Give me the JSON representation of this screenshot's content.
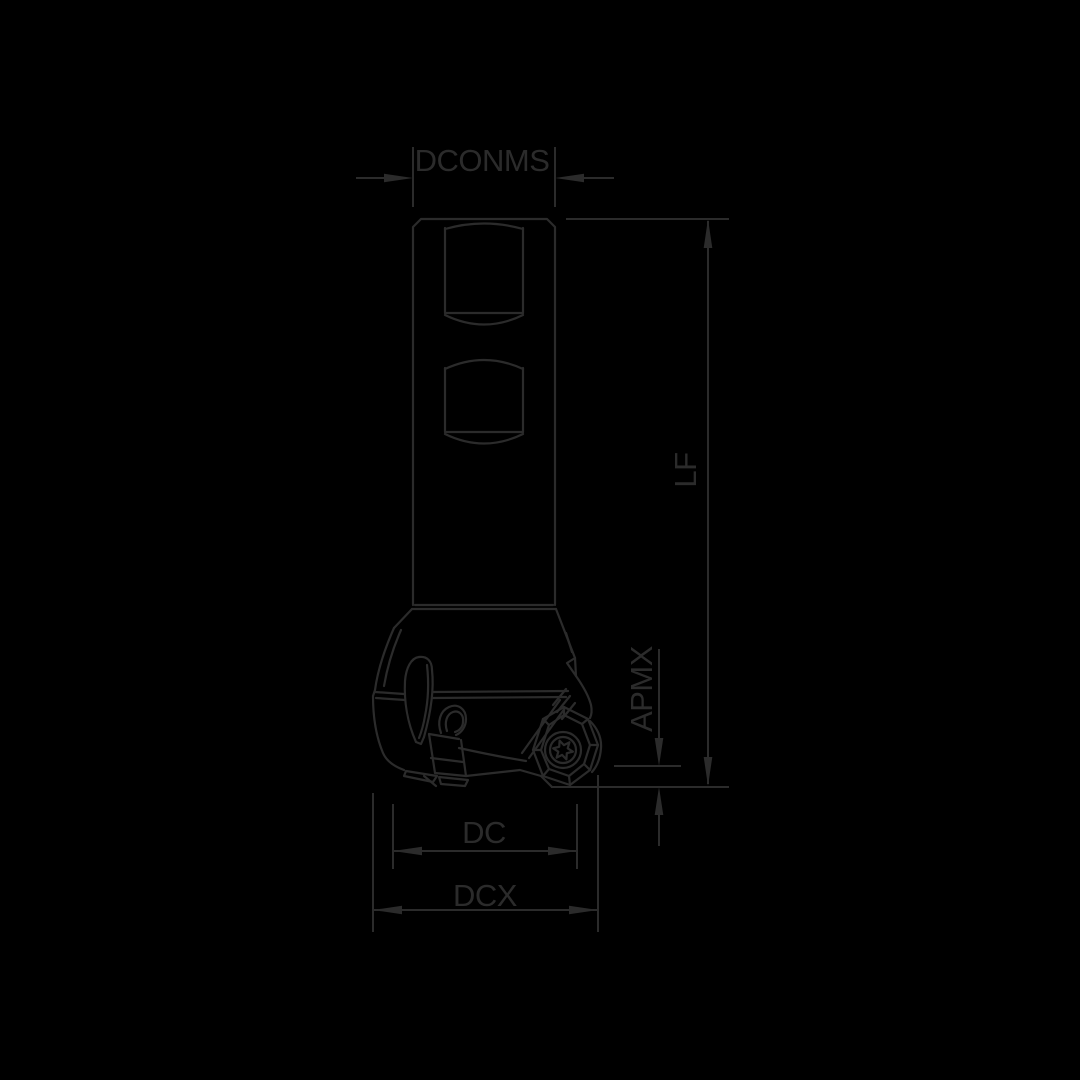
{
  "drawing": {
    "colors": {
      "background": "#000000",
      "line": "#2b2b2b"
    },
    "labels": {
      "dconms": "DCONMS",
      "lf": "LF",
      "apmx": "APMX",
      "dc": "DC",
      "dcx": "DCX"
    }
  }
}
